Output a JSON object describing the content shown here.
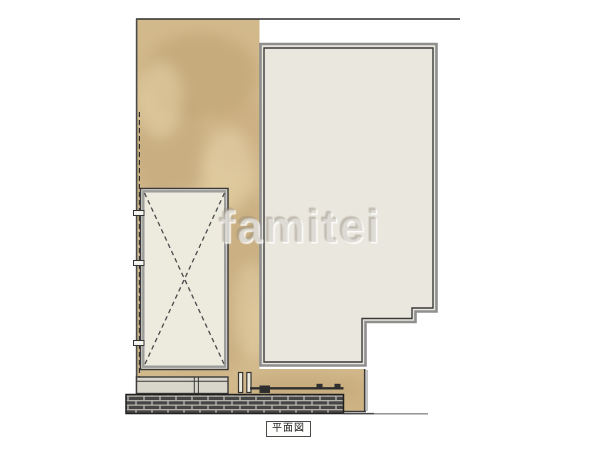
{
  "drawing": {
    "watermark": "famitei",
    "caption": "平面図"
  },
  "colors": {
    "paper_white": "#ffffff",
    "ground_tan": "#d2b98b",
    "ground_tan_dark": "#b79c6c",
    "ground_tan_light": "#ecd9b0",
    "building_fill": "#eae7de",
    "carport_fill": "#edeade",
    "terrace_fill": "#d8d5ca",
    "outline_dark": "#3a3a3a",
    "outline_shadow": "#8f8f8f",
    "brick_dark": "#464646",
    "brick_mortar": "#b6b2a9"
  }
}
